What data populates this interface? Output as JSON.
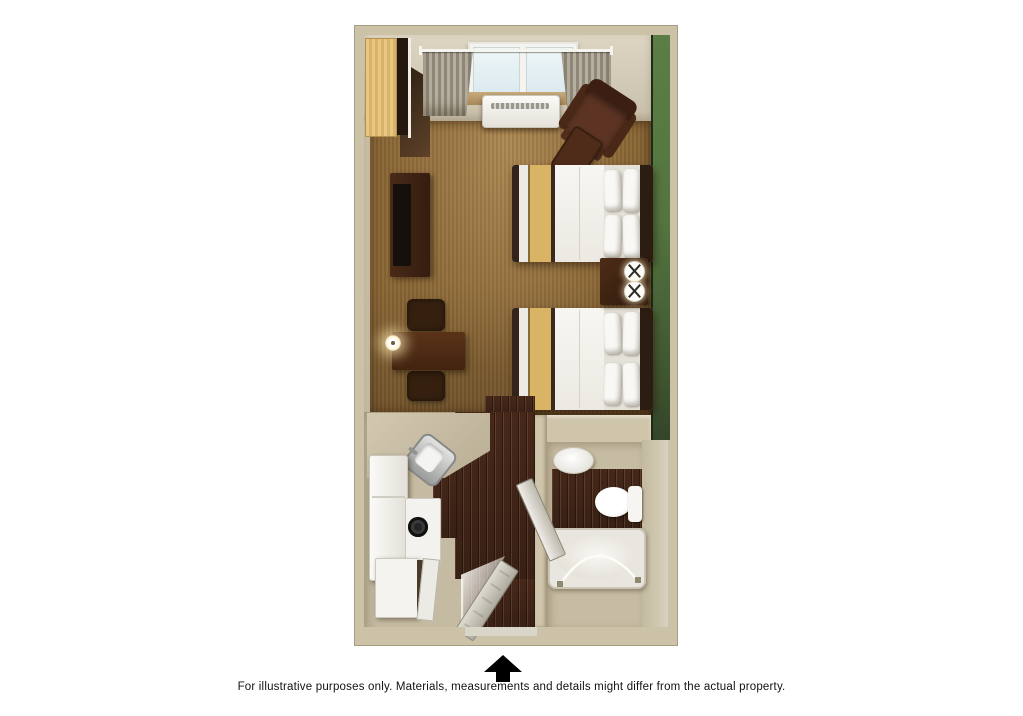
{
  "caption": {
    "text": "For illustrative purposes only.  Materials, measurements and details might differ from the actual property."
  },
  "entrance_arrow": {
    "direction": "up",
    "color": "#000000"
  },
  "floor_plan": {
    "kind": "hotel studio room, 3D top-down rendering",
    "rooms": [
      "main room",
      "kitchenette",
      "bathroom",
      "closet",
      "entry"
    ],
    "furniture": [
      "window with curtains",
      "wall AC unit",
      "armchair with ottoman",
      "two queen beds with tan runners and pillows",
      "nightstand with two lamps",
      "TV dresser",
      "dining table with two chairs",
      "table lamp",
      "kitchen counter with sink",
      "cooktop",
      "refrigerator",
      "cabinet",
      "bathroom sink",
      "toilet",
      "bathtub with shower rod",
      "entry door (open)",
      "bathroom door (open)"
    ],
    "colors": {
      "wall": "#cbc2a8",
      "accent_wall_green": "#557a41",
      "carpet": "#8b6736",
      "wood_floor": "#46281a",
      "counter": "#c9bfa7",
      "linens": "#f4f2ee",
      "bed_runner": "#dab465",
      "dark_furniture": "#3e2315"
    }
  }
}
